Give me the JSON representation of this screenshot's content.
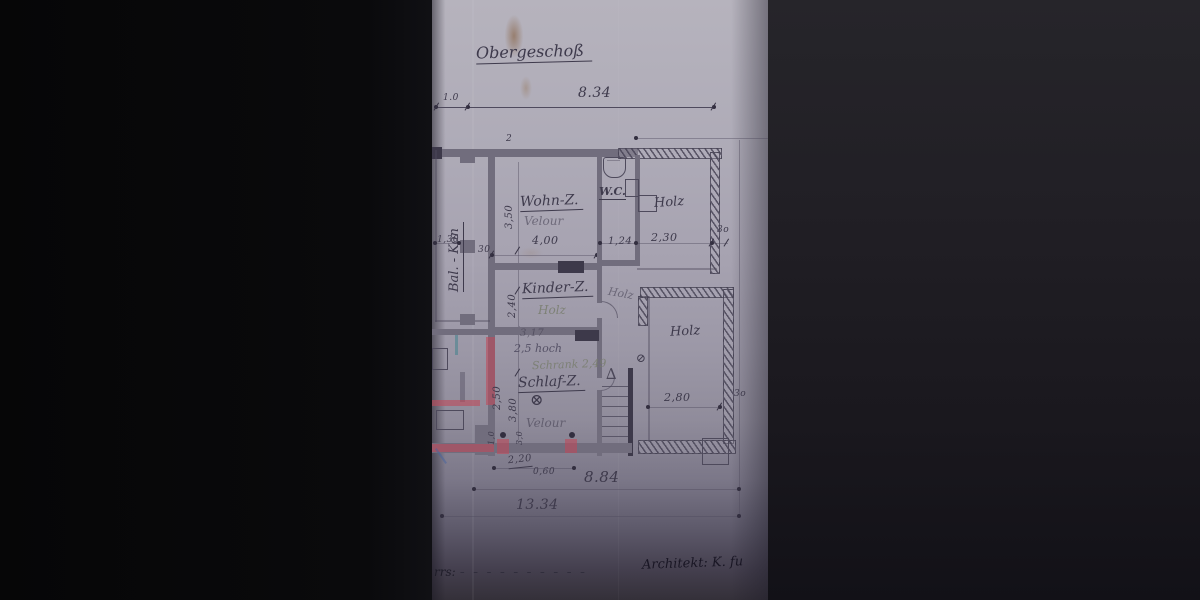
{
  "photo": {
    "title": "Obergeschoß",
    "note_top": "2",
    "icons": {
      "schlaf_mark": "⊗",
      "door_mark": "⊘",
      "stairs_arrow": "∆"
    },
    "rooms": {
      "balkon": {
        "label": "Bal. - Kon"
      },
      "wohn": {
        "label": "Wohn-Z.",
        "floor": "Velour"
      },
      "wc": {
        "label": "W.C."
      },
      "holz_top": {
        "label": "Holz"
      },
      "kinder": {
        "label": "Kinder-Z.",
        "floor": "Holz"
      },
      "flur": {
        "floor": "Holz"
      },
      "holz_right": {
        "label": "Holz"
      },
      "schlaf": {
        "label": "Schlaf-Z.",
        "floor": "Velour"
      }
    },
    "annotations": {
      "width_317": "3,17",
      "height_note": "2,5 hoch",
      "schrank_note": "Schrank 2,49"
    },
    "dims": {
      "top_left": "1.0",
      "top_span": "8.34",
      "bal_width": "1,30",
      "wall": "30",
      "wall_small": "3o",
      "wohn_width": "4,00",
      "wohn_depth": "3,50",
      "wc_width": "1,24",
      "holz_top_width": "2,30",
      "kinder_depth": "2,40",
      "schlaf_depth": "3,80",
      "schlaf_left": "2,50",
      "holz_right_width": "2,80",
      "window_width": "2,20",
      "window_alt": "0,60",
      "bottom_span": "8.84",
      "total_span": "13.34",
      "small_1": "1,0",
      "small_3": "3,0"
    },
    "footer": {
      "left": "rrs:",
      "dashes": "– – – – – – – – – –",
      "architect": "Architekt: K. fu"
    }
  }
}
